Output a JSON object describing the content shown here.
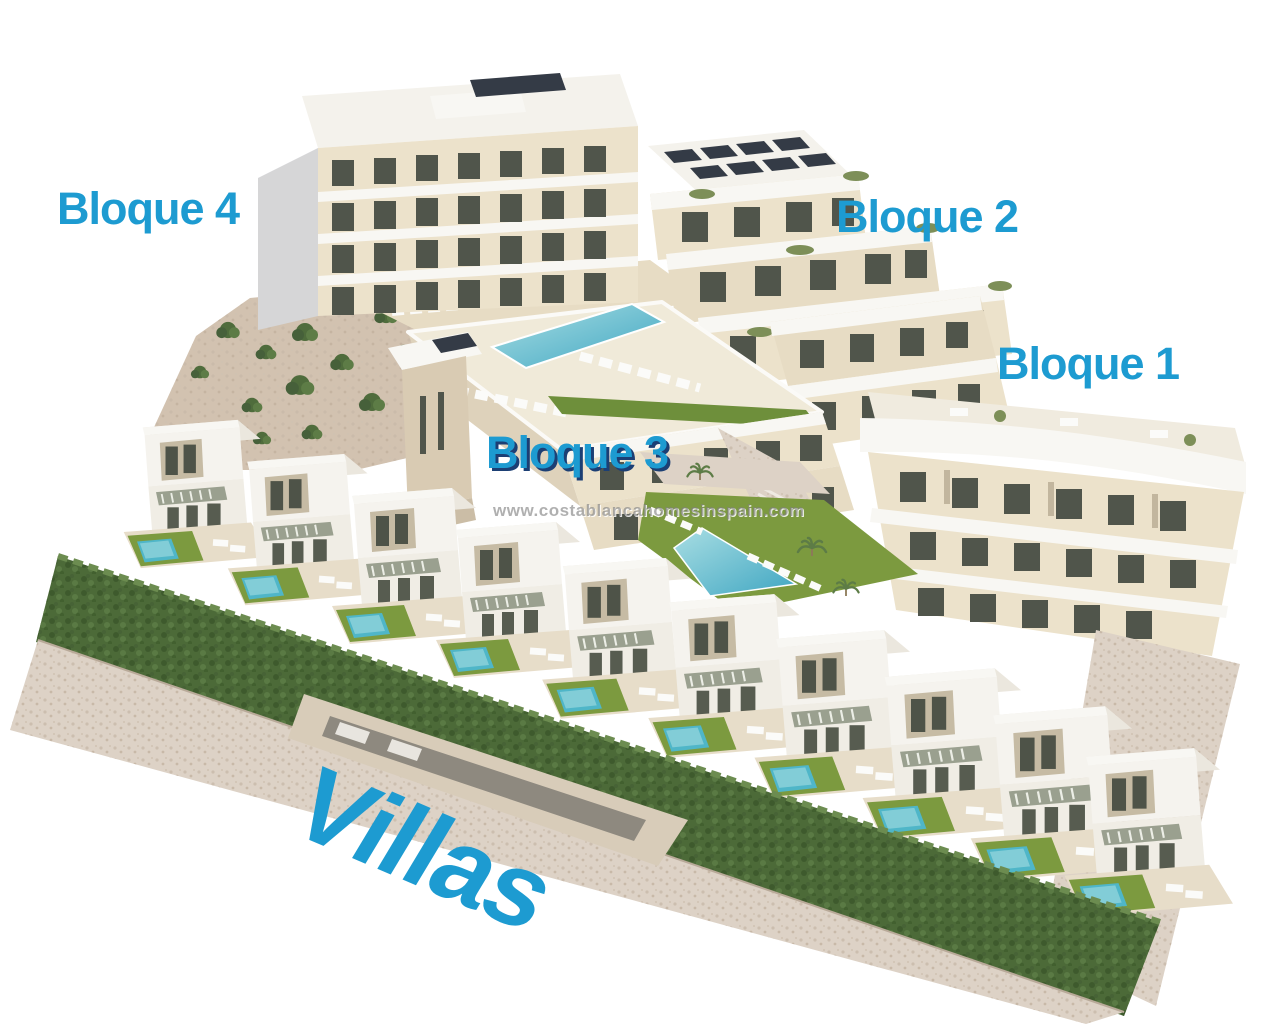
{
  "scene_type": "3d-architectural-render-residential-development",
  "labels": {
    "bloque4": "Bloque 4",
    "bloque2": "Bloque 2",
    "bloque1": "Bloque 1",
    "bloque3": "Bloque 3",
    "villas": "Villas"
  },
  "watermark": {
    "text": "www.costablancahomesinspain.com"
  },
  "palette": {
    "label_blue": "#1d9bd1",
    "bloque3_shadow": "#1c3f74",
    "watermark_gray": "#8c8c8c",
    "building_cream": "#ece2cb",
    "roof_white": "#f4f2ec",
    "pool_turquoise": "#52b7c9",
    "lawn_green": "#7c9a3f",
    "hedge_green": "#4c6a38",
    "gravel_stone": "#ddd2c6",
    "solar_dark": "#343b46"
  }
}
